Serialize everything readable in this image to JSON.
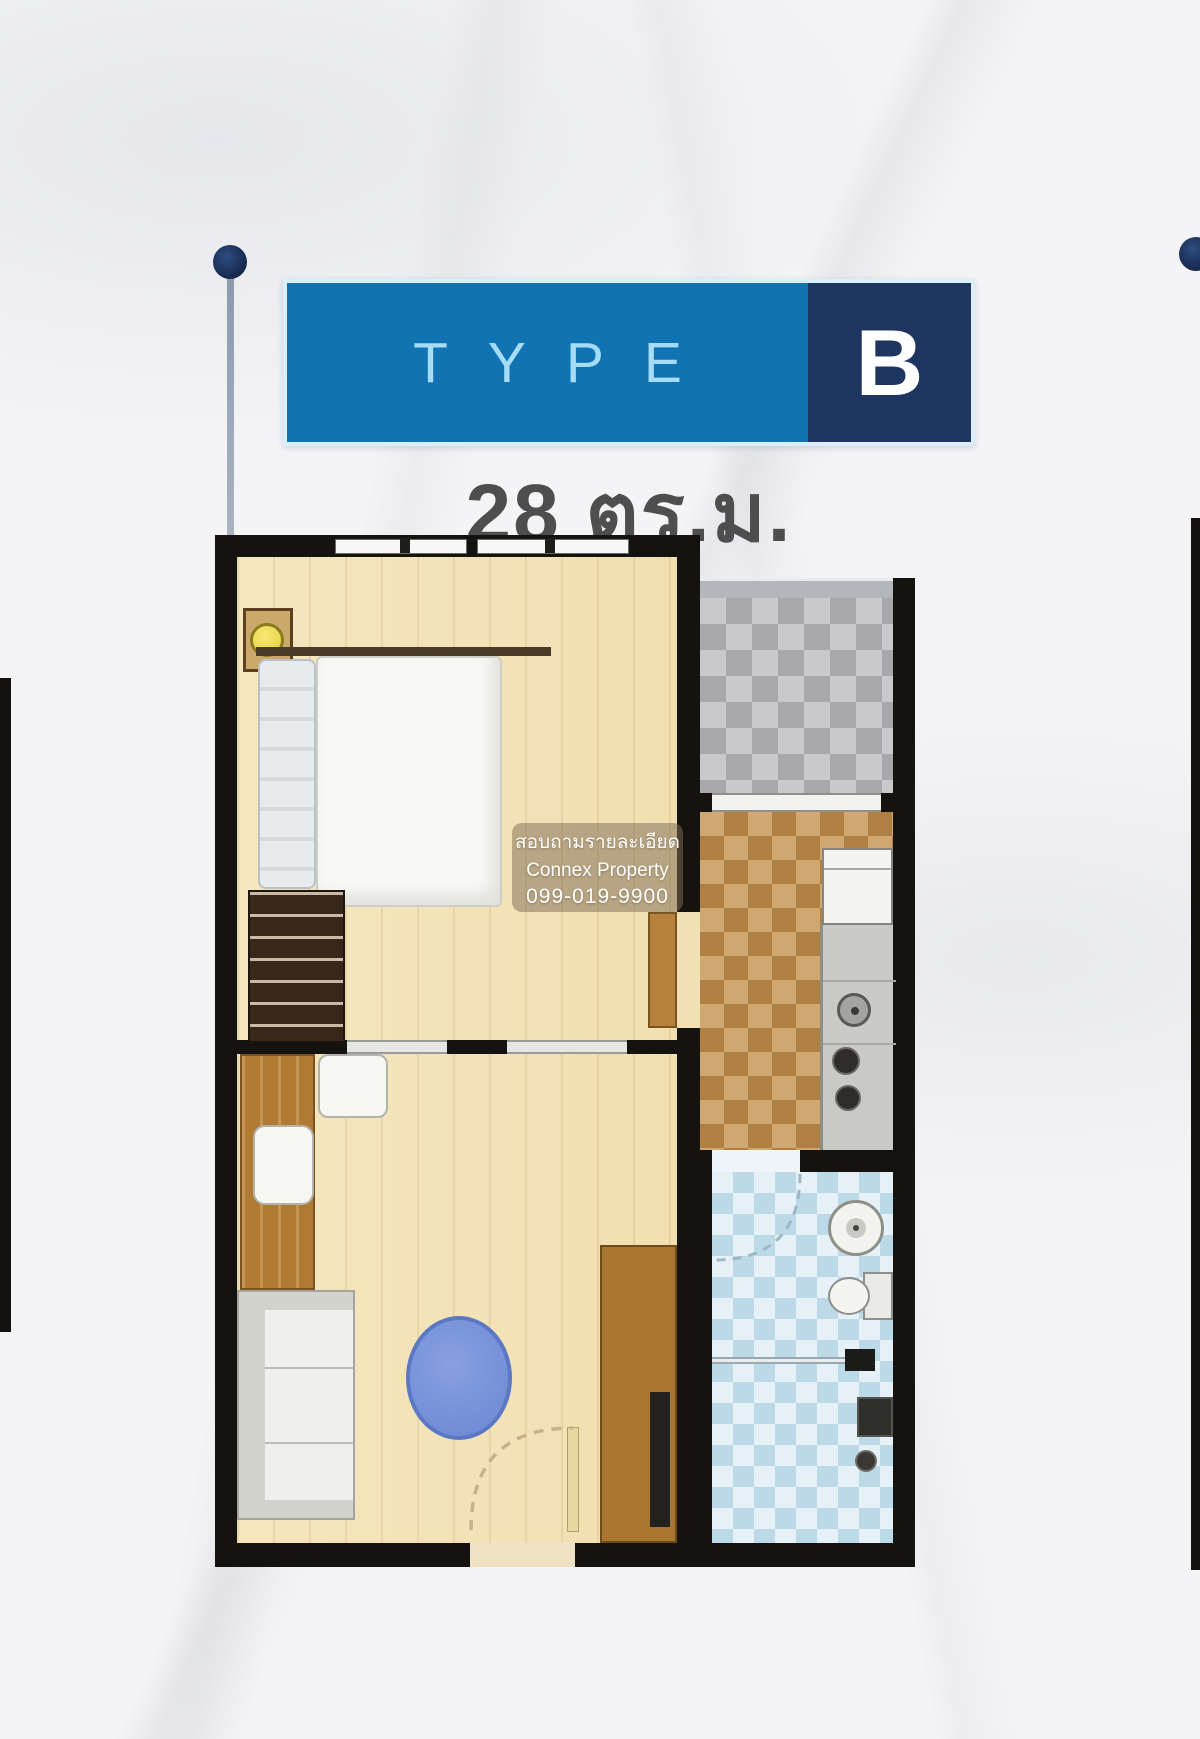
{
  "banner": {
    "type_label": "TYPE",
    "unit_label": "B"
  },
  "area": {
    "label": "28 ตร.ม."
  },
  "watermark": {
    "line1": "สอบถามรายละเอียด",
    "line2": "Connex Property",
    "line3": "099-019-9900"
  },
  "colors": {
    "banner_blue": "#1173b1",
    "banner_navy": "#1e3560",
    "banner_border_light": "#dceefb",
    "type_text_blue": "#a5dcf6",
    "unit_text_white": "#ffffff",
    "area_text_gray": "#4e4e4e",
    "callout_navy": "#17284d",
    "wall_black": "#151310",
    "floor_wood_cream": "#f3e2b6",
    "balcony_checker_gray": "#a8a8aa",
    "kitchen_checker_brown": "#b07f42",
    "bathroom_checker_blue": "#bcd9e8",
    "rug_blue": "#7490d8",
    "lamp_yellow": "#f3e158",
    "wardrobe_brown": "#38281a",
    "closet_brown": "#a8762f",
    "background_marble": "#f4f4f6"
  }
}
